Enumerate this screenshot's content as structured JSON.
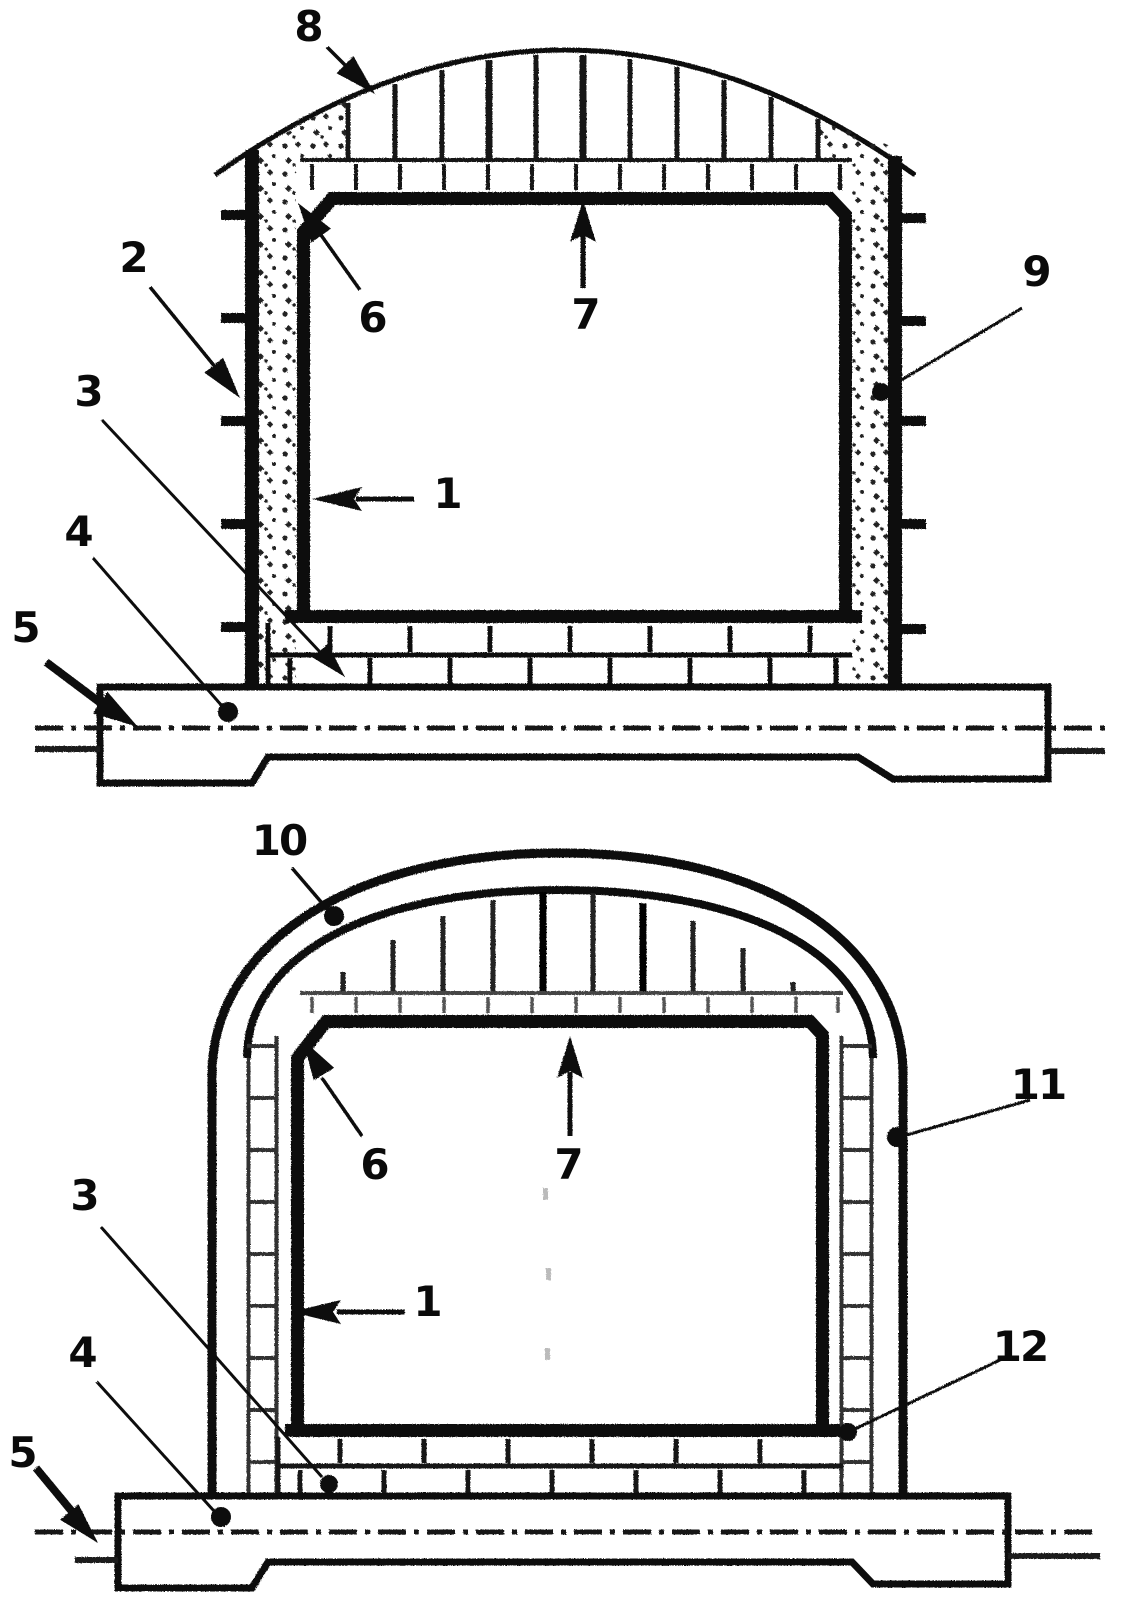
{
  "figures": {
    "top": {
      "labels": {
        "ref1": "1",
        "ref2": "2",
        "ref3": "3",
        "ref4": "4",
        "ref5": "5",
        "ref6": "6",
        "ref7": "7",
        "ref8": "8",
        "ref9": "9"
      }
    },
    "bottom": {
      "labels": {
        "ref1": "1",
        "ref3": "3",
        "ref4": "4",
        "ref5": "5",
        "ref6": "6",
        "ref7": "7",
        "ref10": "10",
        "ref11": "11",
        "ref12": "12"
      }
    }
  },
  "line_color": "#0a0a0a",
  "background_color": "#ffffff"
}
